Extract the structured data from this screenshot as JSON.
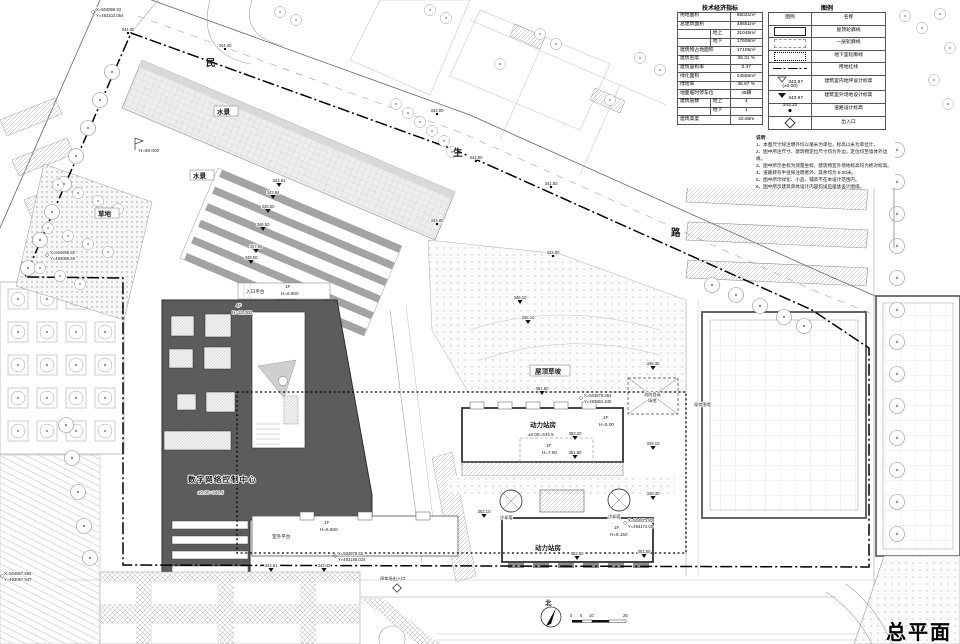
{
  "title": {
    "text": "总平面图"
  },
  "panel": {
    "tech": {
      "title": "技术经济指标",
      "rows": [
        {
          "k": "用地面积",
          "v": "65021m²"
        },
        {
          "k": "总建筑面积",
          "v": "48651m²"
        },
        {
          "sub": "地上",
          "v": "31045m²"
        },
        {
          "sub": "地下",
          "v": "17606m²"
        },
        {
          "k": "建筑物占地面积",
          "v": "17105m²"
        },
        {
          "k": "建筑密度",
          "v": "26.31 %"
        },
        {
          "k": "建筑容积率",
          "v": "0.47"
        },
        {
          "k": "绿化面积",
          "v": "24555m²"
        },
        {
          "k": "绿地率",
          "v": "36.87 %"
        },
        {
          "k": "地面临时停车位",
          "v": "48辆"
        },
        {
          "k": "建筑层数",
          "sub": "地上",
          "v": "4"
        },
        {
          "sub": "地下",
          "v": "1"
        },
        {
          "k": "建筑高度",
          "v": "32.50m"
        }
      ]
    },
    "legend": {
      "title": "图例",
      "col_symbol": "图例",
      "col_name": "名称",
      "items": [
        {
          "name": "屋顶轮廓线"
        },
        {
          "name": "一层轮廓线"
        },
        {
          "name": "地下室轮廓线"
        },
        {
          "name": "用地红线"
        },
        {
          "name": "建筑室内地坪设计标高",
          "v1": "343.97",
          "v2": "(±0.00)"
        },
        {
          "name": "建筑室外场地设计标高",
          "v1": "343.97"
        },
        {
          "name": "道路设计标高",
          "v1": "343.20"
        },
        {
          "name": "出入口"
        }
      ]
    },
    "notes": {
      "title": "说明:",
      "lines": [
        "1、本图尺寸除注明外均以毫米为单位，标高以米为单位计。",
        "2、图中所注尺寸、建筑物定位尺寸均为外边，定位均至墙体外边缘。",
        "3、图中所示坐标为测量坐标，建筑物室外场地标高均为绝对标高。",
        "4、道路转弯半径除注明者外，其余均为 6.00米。",
        "5、图中所示绿化、小品、铺装不在本设计范围内。",
        "6、图中所示建筑单体设计内容均详见单体设计图纸。"
      ]
    }
  },
  "road_chars": [
    "民",
    "生",
    "路"
  ],
  "labels": {
    "water": "水景",
    "grass": "草地",
    "roof_slope": "屋顶草坡",
    "power": "动力站房",
    "center": "数字网络控制中心",
    "entry_platform": "入口平台",
    "outdoor_platform": "室外平台",
    "parking_entry": "停车场出入口",
    "cooling": "冷却塔",
    "fire1": "消防登高",
    "fire2": "场地",
    "wall": "现状围墙",
    "north": "北"
  },
  "annots": {
    "roof_f": "4F",
    "roof_h": "H=32.000",
    "entry_f": "1F",
    "entry_h": "H=6.600",
    "out_f": "1F",
    "out_h": "H=6.600",
    "p1_f": "1F",
    "p1_h": "H=5.00",
    "p2_f": "1F",
    "p2_h": "H=7.90",
    "p3_f": "1F",
    "p3_h": "H=8.150",
    "zero_main": "±0.00=344.5",
    "zero_p1": "±0.00=344.5",
    "flag": "H=60.000"
  },
  "elev": [
    "344.60",
    "344.40",
    "343.00",
    "342.80",
    "341.50",
    "343.80",
    "342.00",
    "343.61",
    "343.94",
    "345.50",
    "346.50",
    "347.95",
    "348.50",
    "346.10",
    "348.10",
    "351.60",
    "348.30",
    "353.20",
    "351.80",
    "352.10",
    "349.10",
    "349.30",
    "352.60",
    "351.50",
    "343.61",
    "343.42"
  ],
  "coords": [
    {
      "x": "X=504898.93",
      "y": "Y=493102.054"
    },
    {
      "x": "X=504895.50",
      "y": "Y=493065.50"
    },
    {
      "x": "X=504876.364",
      "y": "Y=493861.340"
    },
    {
      "x": "X=504873.82",
      "y": "Y=493172.00"
    },
    {
      "x": "X=504878.65",
      "y": "Y=493188.024"
    },
    {
      "x": "X=504867.893",
      "y": "Y=493087.947"
    }
  ],
  "scalebar": {
    "n0": "0",
    "n1": "5",
    "n2": "10",
    "n3": "25"
  }
}
